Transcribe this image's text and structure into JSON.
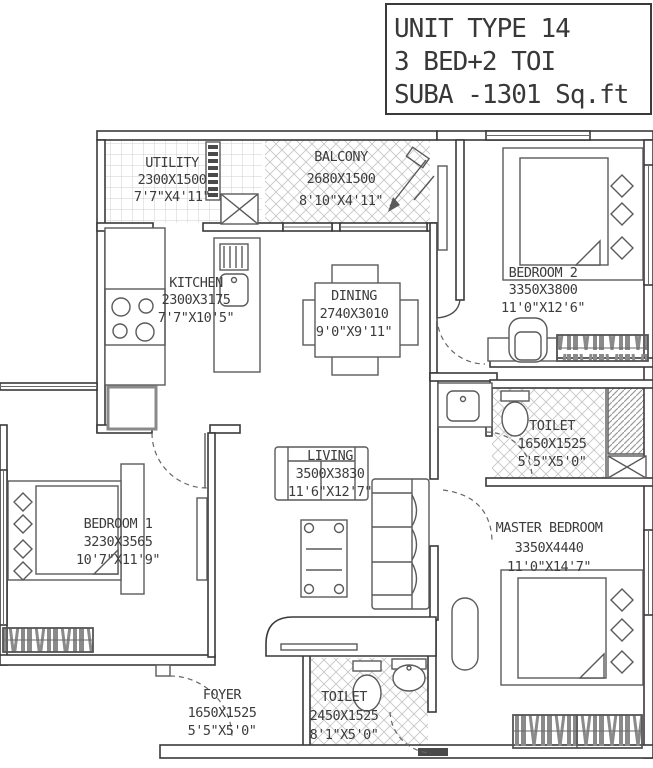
{
  "title_block": {
    "line1": "UNIT TYPE 14",
    "line2": "3 BED+2 TOI",
    "line3": "SUBA -1301 Sq.ft"
  },
  "rooms": {
    "utility": {
      "name": "UTILITY",
      "mm": "2300X1500",
      "ft": "7'7\"X4'11\""
    },
    "balcony": {
      "name": "BALCONY",
      "mm": "2680X1500",
      "ft": "8'10\"X4'11\""
    },
    "kitchen": {
      "name": "KITCHEN",
      "mm": "2300X3175",
      "ft": "7'7\"X10'5\""
    },
    "dining": {
      "name": "DINING",
      "mm": "2740X3010",
      "ft": "9'0\"X9'11\""
    },
    "bedroom2": {
      "name": "BEDROOM 2",
      "mm": "3350X3800",
      "ft": "11'0\"X12'6\""
    },
    "toilet1": {
      "name": "TOILET",
      "mm": "1650X1525",
      "ft": "5'5\"X5'0\""
    },
    "living": {
      "name": "LIVING",
      "mm": "3500X3830",
      "ft": "11'6\"X12'7\""
    },
    "bedroom1": {
      "name": "BEDROOM 1",
      "mm": "3230X3565",
      "ft": "10'7\"X11'9\""
    },
    "master": {
      "name": "MASTER BEDROOM",
      "mm": "3350X4440",
      "ft": "11'0\"X14'7\""
    },
    "foyer": {
      "name": "FOYER",
      "mm": "1650X1525",
      "ft": "5'5\"X5'0\""
    },
    "toilet2": {
      "name": "TOILET",
      "mm": "2450X1525",
      "ft": "8'1\"X5'0\""
    }
  },
  "colors": {
    "wall_line": "#3a3a3a",
    "hatch": "#c8c8c8",
    "text": "#3c3c3c"
  }
}
